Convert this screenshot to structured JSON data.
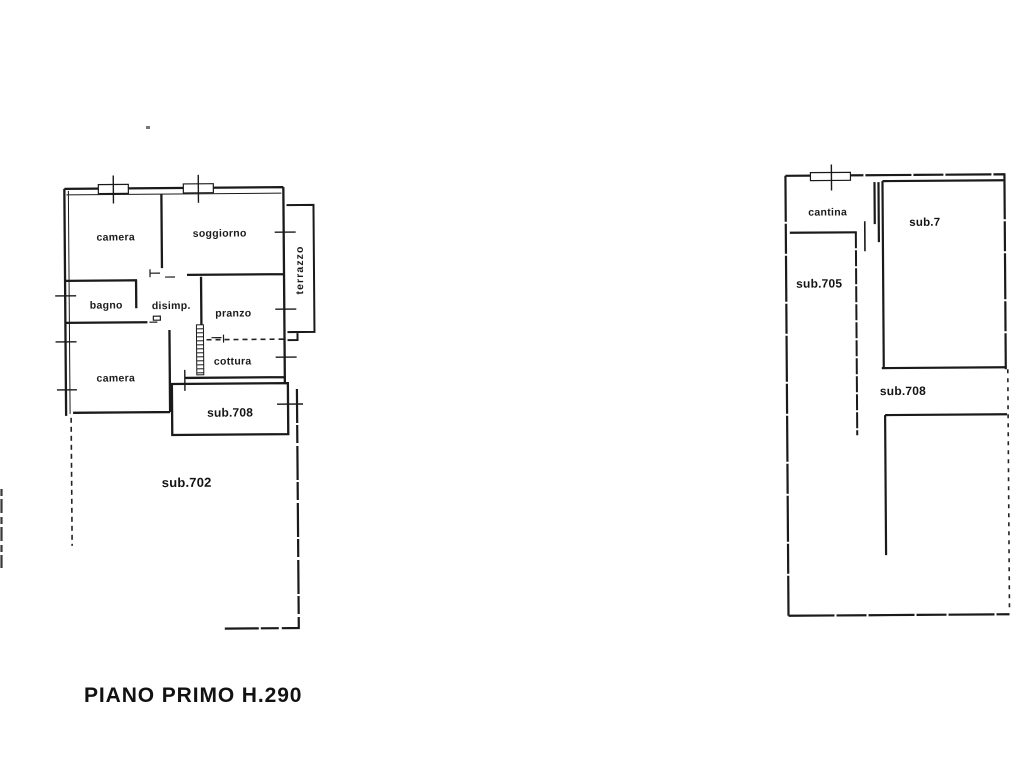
{
  "page": {
    "background": "#ffffff",
    "ink": "#1a1a1a",
    "title": "PIANO PRIMO H.290"
  },
  "plans": {
    "left": {
      "name": "apartment-plan",
      "rooms": [
        {
          "id": "camera-1",
          "label": "camera"
        },
        {
          "id": "soggiorno",
          "label": "soggiorno"
        },
        {
          "id": "bagno",
          "label": "bagno"
        },
        {
          "id": "disimpegno",
          "label": "disimp."
        },
        {
          "id": "pranzo",
          "label": "pranzo"
        },
        {
          "id": "cottura",
          "label": "cottura"
        },
        {
          "id": "camera-2",
          "label": "camera"
        },
        {
          "id": "sub-708",
          "label": "sub.708"
        },
        {
          "id": "sub-702",
          "label": "sub.702"
        },
        {
          "id": "terrazzo",
          "label": "terrazzo"
        }
      ]
    },
    "right": {
      "name": "cellar-plan",
      "rooms": [
        {
          "id": "cantina",
          "label": "cantina"
        },
        {
          "id": "sub-7",
          "label": "sub.7"
        },
        {
          "id": "sub-705",
          "label": "sub.705"
        },
        {
          "id": "sub-708-b",
          "label": "sub.708"
        }
      ]
    }
  }
}
